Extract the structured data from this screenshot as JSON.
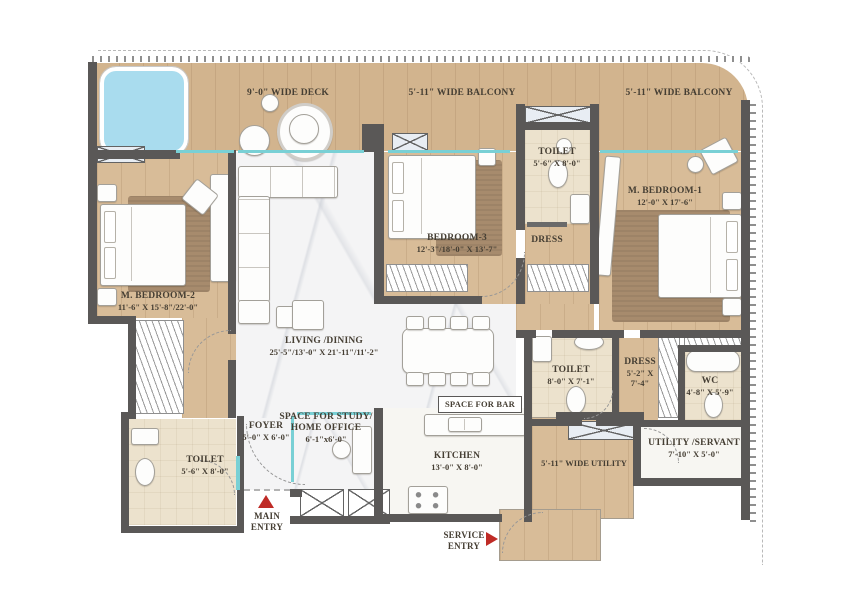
{
  "title": "apartment-floor-plan",
  "colors": {
    "wall": "#5a5857",
    "wood_floor": "#d8bc98",
    "marble_floor": "#f4f4f5",
    "bath_floor": "#ece2cd",
    "window_teal": "#79d0d5",
    "entry_red": "#bf2b26",
    "pool_blue": "#a9dcee",
    "text": "#453e33"
  },
  "areas": {
    "deck": {
      "label": "9'-0\" WIDE DECK"
    },
    "balcony_center": {
      "label": "5'-11\" WIDE BALCONY"
    },
    "balcony_right": {
      "label": "5'-11\" WIDE BALCONY"
    },
    "m_bedroom_2": {
      "label": "M. BEDROOM-2",
      "dims": "11'-6\" X 15'-8\"/22'-0\""
    },
    "living_dining": {
      "label": "LIVING /DINING",
      "dims": "25'-5\"/13'-0\" X 21'-11\"/11'-2\""
    },
    "bedroom_3": {
      "label": "BEDROOM-3",
      "dims": "12'-3\"/18'-0\" X 13'-7\""
    },
    "toilet_bedroom_3": {
      "label": "TOILET",
      "dims": "5'-6\" X 8'-0\""
    },
    "dress_bedroom_3": {
      "label": "DRESS"
    },
    "m_bedroom_1": {
      "label": "M. BEDROOM-1",
      "dims": "12'-0\" X 17'-6\""
    },
    "toilet_common": {
      "label": "TOILET",
      "dims": "8'-0\" X 7'-1\""
    },
    "dress_m_bedroom_1": {
      "label": "DRESS",
      "dims_line1": "5'-2\" X",
      "dims_line2": "7'-4\""
    },
    "wc": {
      "label": "WC",
      "dims": "4'-8\" X 5'-9\""
    },
    "utility_servant": {
      "label": "UTILITY /SERVANT",
      "dims": "7'-10\" X 5'-0\""
    },
    "space_for_bar": {
      "label": "SPACE FOR BAR"
    },
    "kitchen": {
      "label": "KITCHEN",
      "dims": "13'-0\" X 8'-0\""
    },
    "wide_utility": {
      "label": "5'-11\" WIDE UTILITY"
    },
    "foyer": {
      "label": "FOYER",
      "dims": "5'-0\" X 6'-0\""
    },
    "study": {
      "label_line1": "SPACE FOR STUDY/",
      "label_line2": "HOME OFFICE",
      "dims": "6'-1\"x6'-0\""
    },
    "toilet_entry": {
      "label": "TOILET",
      "dims": "5'-6\" X 8'-0\""
    }
  },
  "entries": {
    "main": {
      "line1": "MAIN",
      "line2": "ENTRY"
    },
    "service": {
      "line1": "SERVICE",
      "line2": "ENTRY"
    }
  }
}
